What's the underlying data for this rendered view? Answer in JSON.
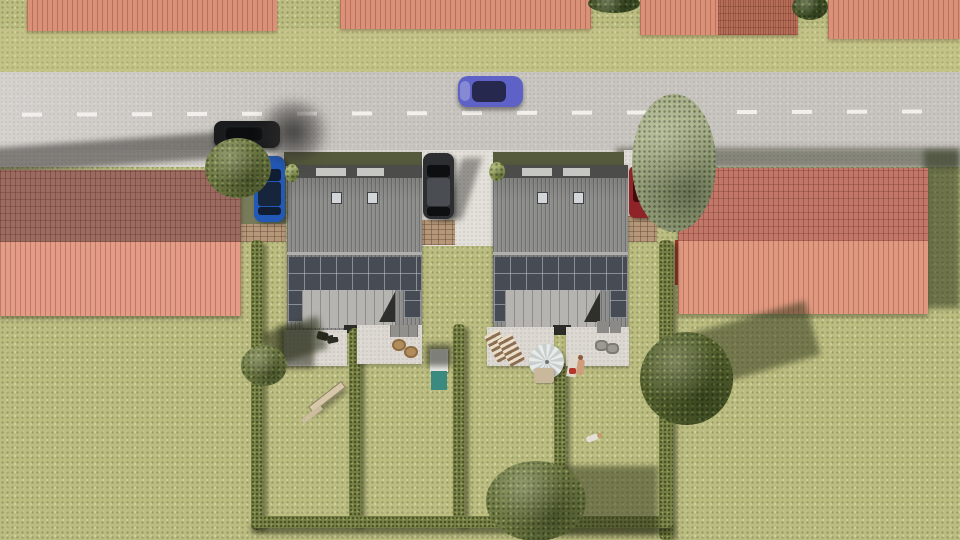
{
  "scene": {
    "type": "aerial 3D architectural visualization, top-down view",
    "summary": "Two new semi-detached houses with rooftop solar panels set between existing red-roofed buildings along a road; hedged rear gardens with patios, parasol, play equipment, trees and parked cars; one car driving on the road"
  },
  "palette": {
    "grass": "#bcbd81",
    "grass_sunny": "#c9c98f",
    "road": "#c8c4bf",
    "road_dash": "#f2f0ec",
    "sidewalk": "#d8d4ce",
    "concrete_drive": "#e3dfd9",
    "paver_brick": "#b49879",
    "roof_red": "#db9078",
    "roof_red_shaded": "#9b6a60",
    "roof_red_sunlit": "#e49c86",
    "right_roof_shaded": "#c27768",
    "right_roof_sunlit": "#e0987f",
    "house_roof_gray": "#8d8d8b",
    "house_ext_roof": "#b6b4b0",
    "solar_panel": "#474b53",
    "hedge_green": "#7a8347",
    "tree_olive": "#6f7a44",
    "tree_sage": "#a4ad88",
    "tree_dark": "#55622f",
    "patio_stone": "#dcd8d1",
    "playhouse_teal": "#3a8a80",
    "car_driving": "#5e62c6",
    "car_parked_black": "#1a1b1d",
    "car_hatchback_blue": "#2258b6",
    "car_suv_gray": "#2c2e31",
    "car_red": "#8e2328"
  },
  "objects": {
    "buildings": [
      {
        "name": "top-left-building",
        "roof": "red corrugated"
      },
      {
        "name": "top-center-building",
        "roof": "red corrugated"
      },
      {
        "name": "top-right-building",
        "roof": "red corrugated, two-tone slopes"
      },
      {
        "name": "top-far-right-building",
        "roof": "red corrugated"
      },
      {
        "name": "left-apartment-block",
        "roof": "red gable, shaded north slope, sunlit south slope"
      },
      {
        "name": "right-apartment-block",
        "roof": "red gable, shaded north slope, sunlit south slope"
      },
      {
        "name": "house-1",
        "roof": "dark gray, 2 ridge vents, 2 skylights, solar array, rear extension"
      },
      {
        "name": "house-2",
        "roof": "dark gray, 2 ridge vents, 2 skylights, solar array, rear extension"
      }
    ],
    "cars": [
      {
        "name": "driving-car",
        "color_key": "car_driving",
        "location": "road, heading left"
      },
      {
        "name": "parked-black-car",
        "color_key": "car_parked_black",
        "location": "road edge under tree"
      },
      {
        "name": "blue-hatchback",
        "color_key": "car_hatchback_blue",
        "location": "left driveway"
      },
      {
        "name": "gray-suv",
        "color_key": "car_suv_gray",
        "location": "center driveway"
      },
      {
        "name": "red-car",
        "color_key": "car_red",
        "location": "right driveway, under tree"
      }
    ],
    "garden": {
      "hedges": 6,
      "trees": 5,
      "patios": 4,
      "items": [
        "dark seating group",
        "sun lounger",
        "canopy pergola",
        "wicker chairs",
        "teal playhouse",
        "striped deck chairs",
        "parasol with table",
        "sunbathing person with towel",
        "gray chairs",
        "storage boxes",
        "seesaw toy",
        "person lying on grass"
      ]
    },
    "road": {
      "lane_marking": "white dashed center line"
    }
  }
}
